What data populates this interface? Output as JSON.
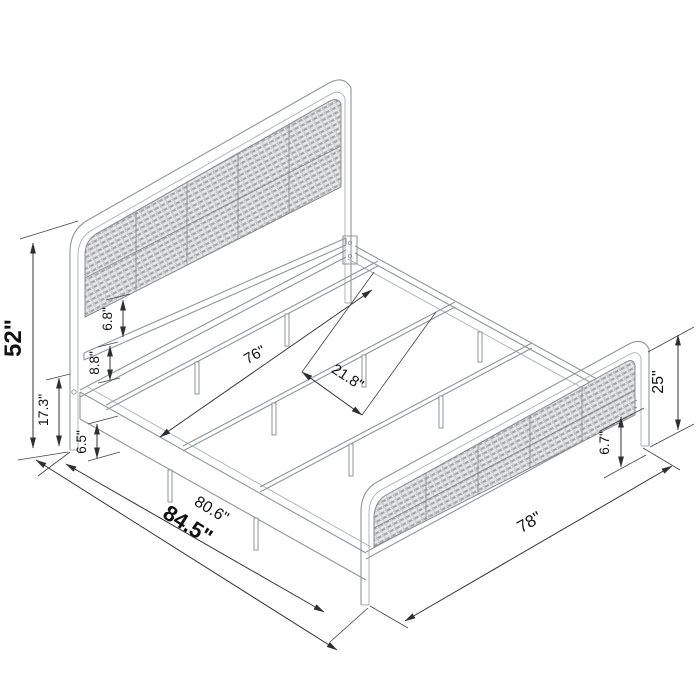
{
  "canvas": {
    "width": 700,
    "height": 700,
    "background": "#ffffff"
  },
  "style": {
    "structure_line_color": "#8f959a",
    "dimension_color": "#333333",
    "panel_fill": "#e6e7e7",
    "weave_stroke_color": "#a2a5a8"
  },
  "diagram": {
    "type": "isometric-line-drawing",
    "unit": "inches",
    "dimensions": {
      "headboard_height": {
        "label": "52\""
      },
      "headboard_leg_height": {
        "label": "17.3\""
      },
      "deck_to_crossbar": {
        "label": "8.8\""
      },
      "crossbar_to_panel": {
        "label": "6.8\""
      },
      "side_rail_depth": {
        "label": "6.5\""
      },
      "slat_length": {
        "label": "76\""
      },
      "slat_spacing": {
        "label": "21.8\""
      },
      "inner_length": {
        "label": "80.6\""
      },
      "total_length": {
        "label": "84.5\""
      },
      "bed_width": {
        "label": "78\""
      },
      "footboard_height": {
        "label": "25\""
      },
      "footboard_clearance": {
        "label": "6.7\""
      }
    }
  }
}
